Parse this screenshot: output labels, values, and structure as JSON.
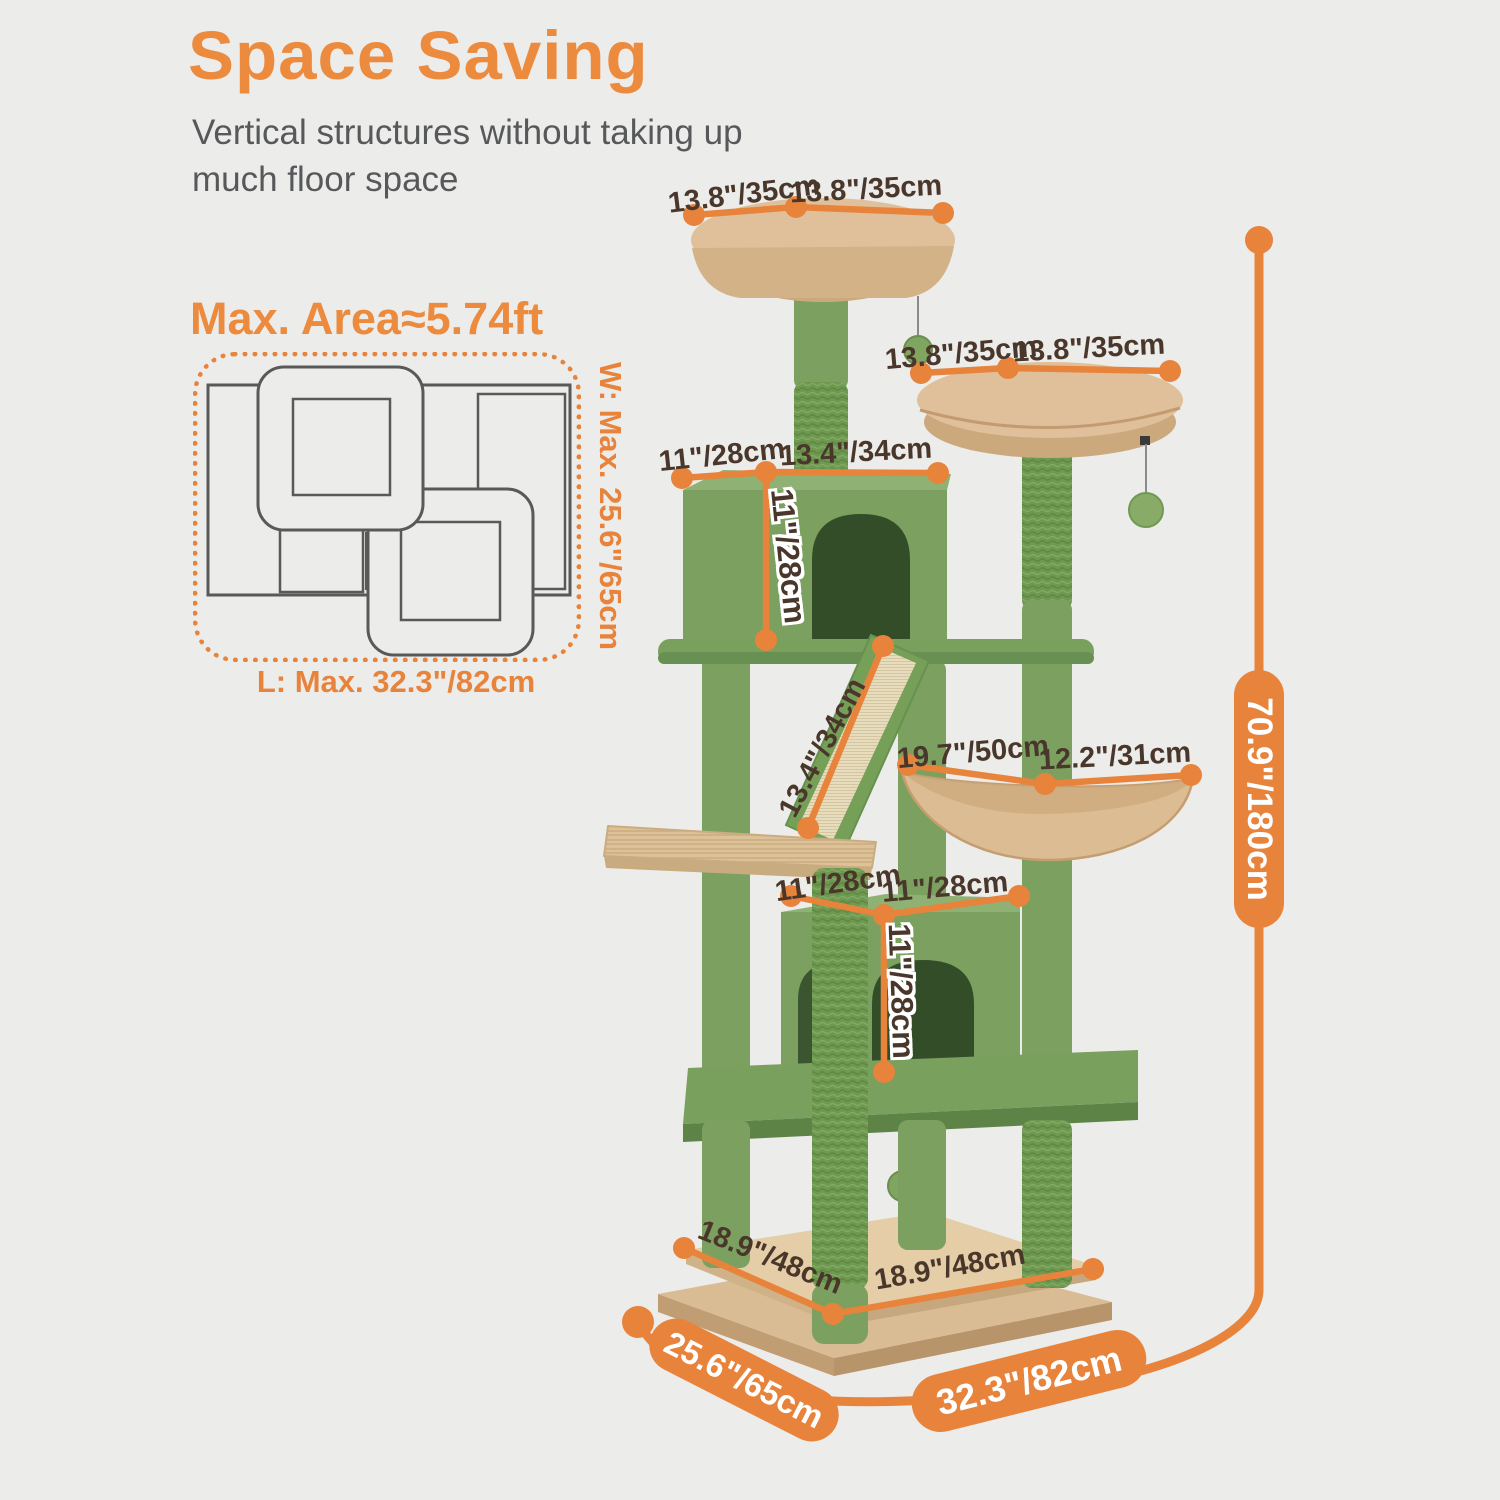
{
  "header": {
    "title": "Space Saving",
    "subtitle_line1": "Vertical structures without taking up",
    "subtitle_line2": "much floor space"
  },
  "floorplan": {
    "title": "Max. Area≈5.74ft",
    "width_label": "W: Max. 25.6\"/65cm",
    "length_label": "L: Max. 32.3\"/82cm"
  },
  "tree_dimensions": {
    "top_perch_left": "13.8\"/35cm",
    "top_perch_right": "13.8\"/35cm",
    "second_perch_left": "13.8\"/35cm",
    "second_perch_right": "13.8\"/35cm",
    "upper_condo_width": "11\"/28cm",
    "upper_condo_depth": "13.4\"/34cm",
    "upper_condo_height": "11\"/28cm",
    "ramp_length": "13.4\"/34cm",
    "hammock_width": "19.7\"/50cm",
    "hammock_depth": "12.2\"/31cm",
    "lower_condo_width": "11\"/28cm",
    "lower_condo_depth": "11\"/28cm",
    "lower_condo_height": "11\"/28cm",
    "base_platform_depth": "18.9\"/48cm",
    "base_platform_width": "18.9\"/48cm",
    "base_depth": "25.6\"/65cm",
    "base_width": "32.3\"/82cm",
    "total_height": "70.9\"/180cm"
  },
  "colors": {
    "accent_orange": "#E8833C",
    "title_orange": "#EC8A3E",
    "label_brown": "#4A372B",
    "subtitle_gray": "#57585A",
    "tree_green_plush": "#7CA05F",
    "tree_green_rope": "#6F9950",
    "tree_beige": "#DCBC92",
    "background": "#ECECEA"
  }
}
